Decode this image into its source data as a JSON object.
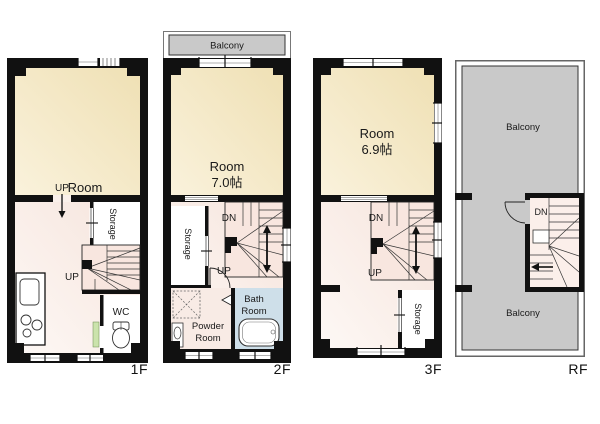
{
  "colors": {
    "wall": "#111111",
    "room_cream": "#F3E6C2",
    "hall_pink": "#FAF0EA",
    "stair_pink": "#F8E4DD",
    "balcony_gray": "#C9C9C9",
    "bath_blue": "#CEDFE9",
    "door_green": "#CBE3AC"
  },
  "floors": {
    "f1": {
      "label": "1F",
      "room_name": "Room",
      "room_size": "7.0帖",
      "entry_up": "UP",
      "stair_up": "UP",
      "storage": "Storage",
      "wc": "WC"
    },
    "f2": {
      "label": "2F",
      "balcony": "Balcony",
      "room_name": "Room",
      "room_size": "7.0帖",
      "stair_dn": "DN",
      "stair_up": "UP",
      "storage": "Storage",
      "powder_line1": "Powder",
      "powder_line2": "Room",
      "bath_line1": "Bath",
      "bath_line2": "Room"
    },
    "f3": {
      "label": "3F",
      "room_name": "Room",
      "room_size": "6.9帖",
      "stair_dn": "DN",
      "stair_up": "UP",
      "storage": "Storage"
    },
    "rf": {
      "label": "RF",
      "balcony_top": "Balcony",
      "balcony_bottom": "Balcony",
      "stair_dn": "DN"
    }
  }
}
